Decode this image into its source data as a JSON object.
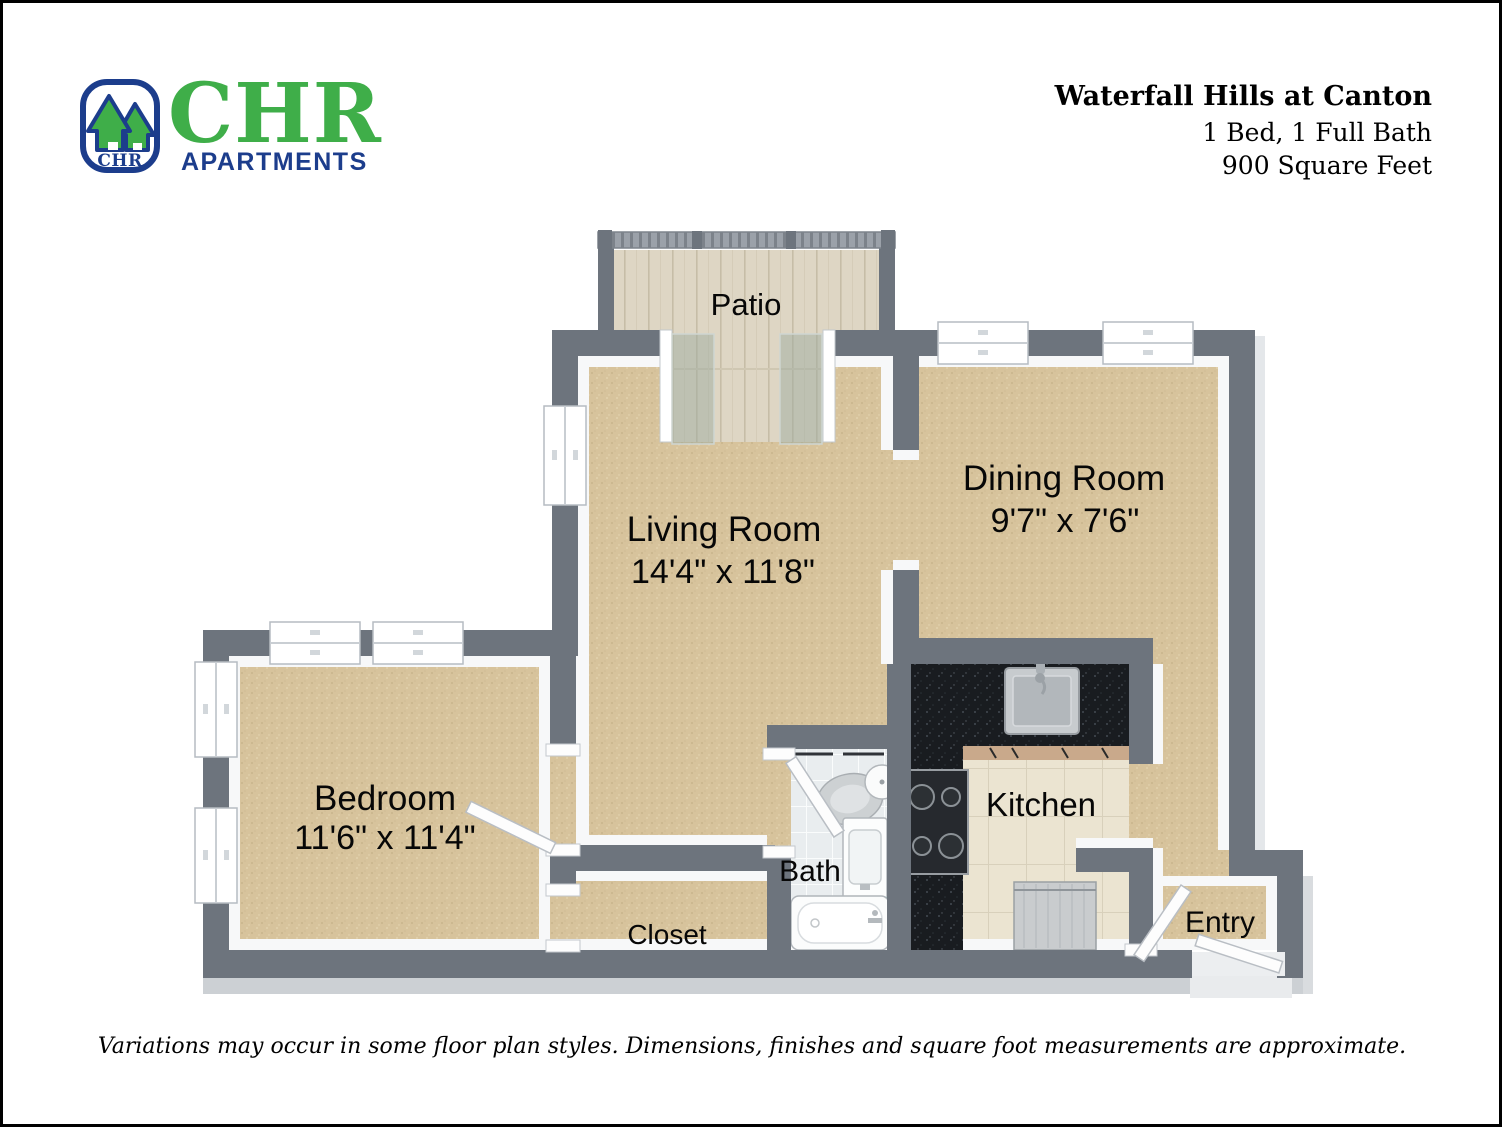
{
  "page": {
    "brand": {
      "logo_monogram": "CHR",
      "name": "CHR",
      "subtitle": "APARTMENTS",
      "green": "#3fae49",
      "blue": "#1c3d8c"
    },
    "title_block": {
      "property_name": "Waterfall Hills at Canton",
      "configuration": "1 Bed, 1 Full Bath",
      "area": "900 Square Feet"
    },
    "disclaimer": "Variations may occur in some floor plan styles. Dimensions, finishes and square foot measurements are approximate."
  },
  "floorplan": {
    "colors": {
      "wall": "#6d747d",
      "wall_base": "#ccd0d4",
      "trim": "#f7f8f9",
      "carpet": "#d7c39c",
      "bath_tile": "#e9edef",
      "kitchen_tile": "#ebe4d1",
      "counter": "#1a1d21",
      "cabinet": "#c9a98b",
      "patio_wood": "#ddd5c2",
      "glass": "#9eac a0"
    },
    "rooms": {
      "patio": {
        "label": "Patio"
      },
      "living_room": {
        "label": "Living Room",
        "dimensions": "14'4\" x 11'8\""
      },
      "dining_room": {
        "label": "Dining Room",
        "dimensions": "9'7\" x 7'6\""
      },
      "bedroom": {
        "label": "Bedroom",
        "dimensions": "11'6\" x 11'4\""
      },
      "bath": {
        "label": "Bath"
      },
      "closet": {
        "label": "Closet"
      },
      "kitchen": {
        "label": "Kitchen"
      },
      "entry": {
        "label": "Entry"
      }
    }
  }
}
